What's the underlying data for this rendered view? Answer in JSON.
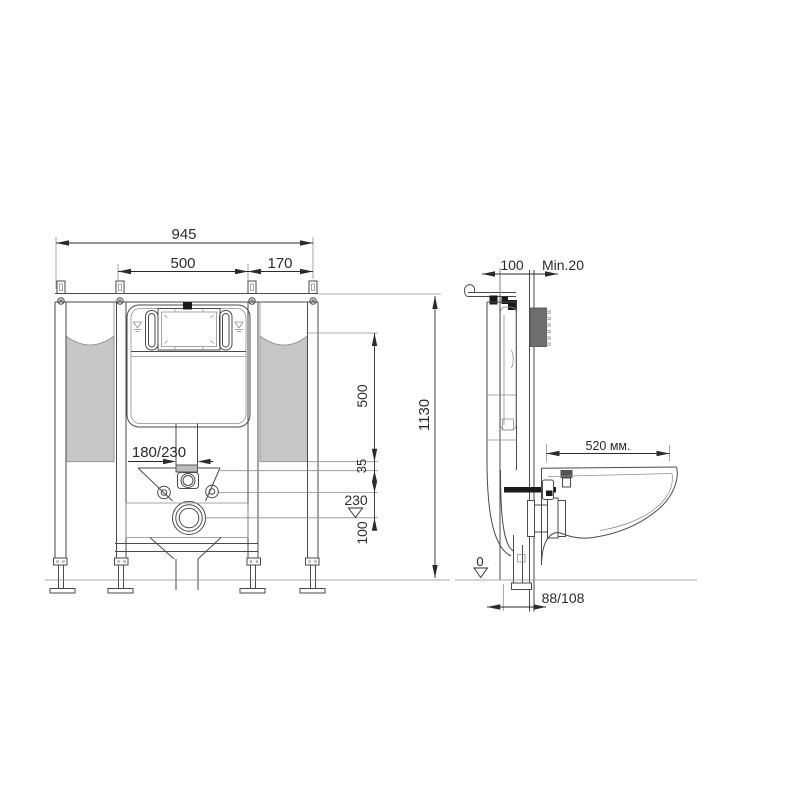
{
  "front": {
    "overall_width": "945",
    "cistern_width": "500",
    "side_offset": "170",
    "flush_pipe_offset": "180/230",
    "tank_height": "500",
    "gap_35": "35",
    "outlet_level": "230",
    "outlet_spacing": "100",
    "overall_height": "1130"
  },
  "side": {
    "frame_depth": "100",
    "min_wall_thickness": "Min.20",
    "bowl_length": "520 мм.",
    "floor_datum": "0",
    "outlet_offset": "88/108"
  },
  "colors": {
    "line": "#4a4a4a",
    "light_line": "#8f8f8f",
    "dim": "#2b2b2b",
    "panel_gray": "#c7c7c7",
    "plate_gray": "#6f6f6f",
    "fitting_gray": "#bcbcbc",
    "black": "#1a1a1a",
    "background": "#ffffff"
  }
}
